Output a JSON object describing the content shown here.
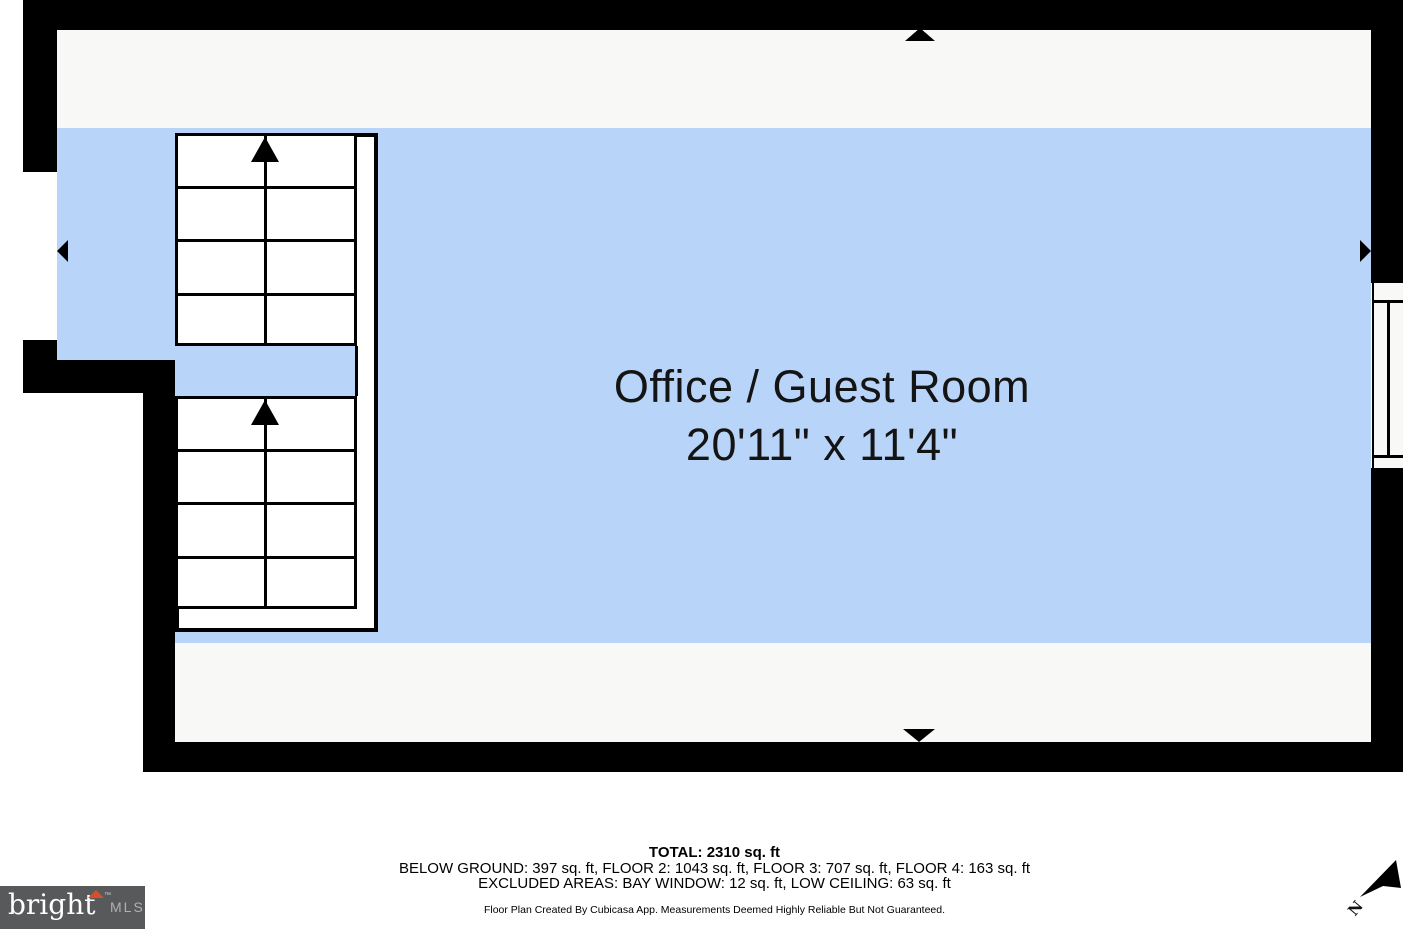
{
  "room": {
    "name": "Office / Guest Room",
    "dimensions": "20'11\" x 11'4\""
  },
  "summary": {
    "total": "TOTAL: 2310 sq. ft",
    "floors": "BELOW GROUND: 397 sq. ft, FLOOR 2: 1043 sq. ft, FLOOR 3: 707 sq. ft, FLOOR 4: 163 sq. ft",
    "excluded": "EXCLUDED AREAS: BAY WINDOW: 12 sq. ft, LOW CEILING: 63 sq. ft",
    "disclaimer": "Floor Plan Created By Cubicasa App. Measurements Deemed Highly Reliable But Not Guaranteed."
  },
  "stairs": {
    "flights": [
      {
        "steps": 4,
        "direction": "up"
      },
      {
        "steps": 4,
        "direction": "up"
      }
    ]
  },
  "icons": {
    "wall_markers": [
      "up-triangle",
      "left-triangle",
      "right-triangle",
      "down-triangle"
    ],
    "compass": "north-arrow"
  },
  "compass": {
    "label": "N"
  },
  "logo": {
    "brand": "bright",
    "trademark": "TM",
    "suffix": "MLS"
  },
  "colors": {
    "room_fill": "#b8d4f8",
    "floor_fill": "#f8f8f6",
    "wall": "#000000",
    "logo_bg": "#58595b",
    "logo_accent": "#d4502a",
    "logo_mls_text": "#aeb0b3"
  }
}
